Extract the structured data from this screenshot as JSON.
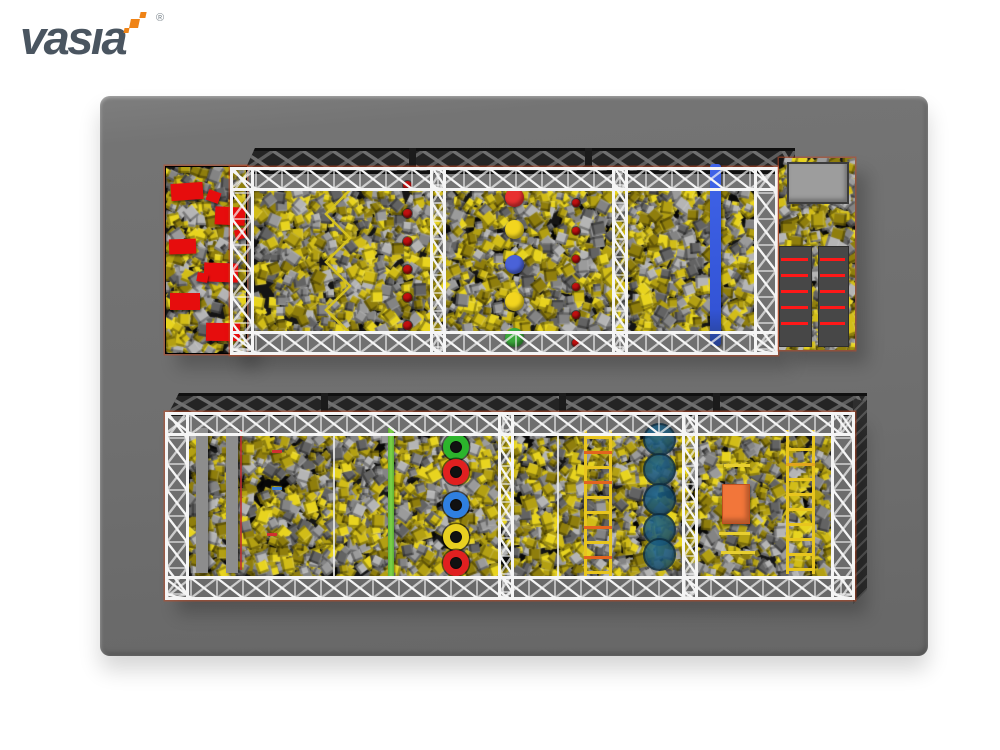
{
  "brand": {
    "logo_text": "vasia",
    "registered_mark": "®",
    "logo_color": "#4a5560",
    "accent_color": "#ef8316"
  },
  "floor": {
    "color": "#6f6f6f"
  },
  "palette": {
    "pit_background": "#141414",
    "foam_yellow": [
      "#e8d41f",
      "#d2bd18",
      "#b3a013",
      "#8f7e0d"
    ],
    "foam_gray": [
      "#b5b5b5",
      "#9b9b9b",
      "#848484",
      "#636363"
    ],
    "truss_white": "#f5f5f5",
    "truss_trim": "#c8481f",
    "band_dark": "#242424",
    "band_pattern": "#707070"
  },
  "top_pit": {
    "red_mat_color": "#e60d0d",
    "red_mat_count": 9,
    "stepping_dot_color": "#c01010",
    "stepping_dot_columns": 2,
    "stepping_dots_per_column": 6,
    "stepping_circle_colors": [
      "#e83030",
      "#f2d51f",
      "#4a62d8",
      "#f2d51f",
      "#3aa83a"
    ],
    "zigzag_beam_color": "#d8c41c",
    "balance_lane_color": "#3f63e8",
    "platform_color": "#9d9d9d",
    "climb_block_color": "#474747",
    "climb_stripe_color": "#ff1818",
    "climb_stripes_per_block": 5
  },
  "bottom_pit": {
    "balance_beam_color": "#8d8d8d",
    "beam_trim_color": "#c03030",
    "green_beam_color": "#7ed348",
    "ring_colors": [
      "#2cb42c",
      "#e02020",
      "#2f7fe0",
      "#e8d020",
      "#e02020"
    ],
    "ladder_rail_color": "#e8c51e",
    "ladder1_rung_colors": [
      "#e8c51e",
      "#e2641e",
      "#e8c51e",
      "#e2641e",
      "#e8c51e",
      "#e8c51e",
      "#e2641e",
      "#e8c51e",
      "#e2641e",
      "#e8c51e"
    ],
    "ladder2_rung_colors": [
      "#e8c51e",
      "#e8c51e",
      "#e2a51e",
      "#e8c51e",
      "#e8c51e",
      "#e8c51e",
      "#e8c51e",
      "#e8c51e",
      "#e8c51e",
      "#e8c51e"
    ],
    "pod_color": "#17506f",
    "mat_color": "#f2763a",
    "accent_bar_color": "#e8cf30",
    "marker_colors": [
      "#d03030",
      "#3a7fd0",
      "#d03030"
    ]
  }
}
